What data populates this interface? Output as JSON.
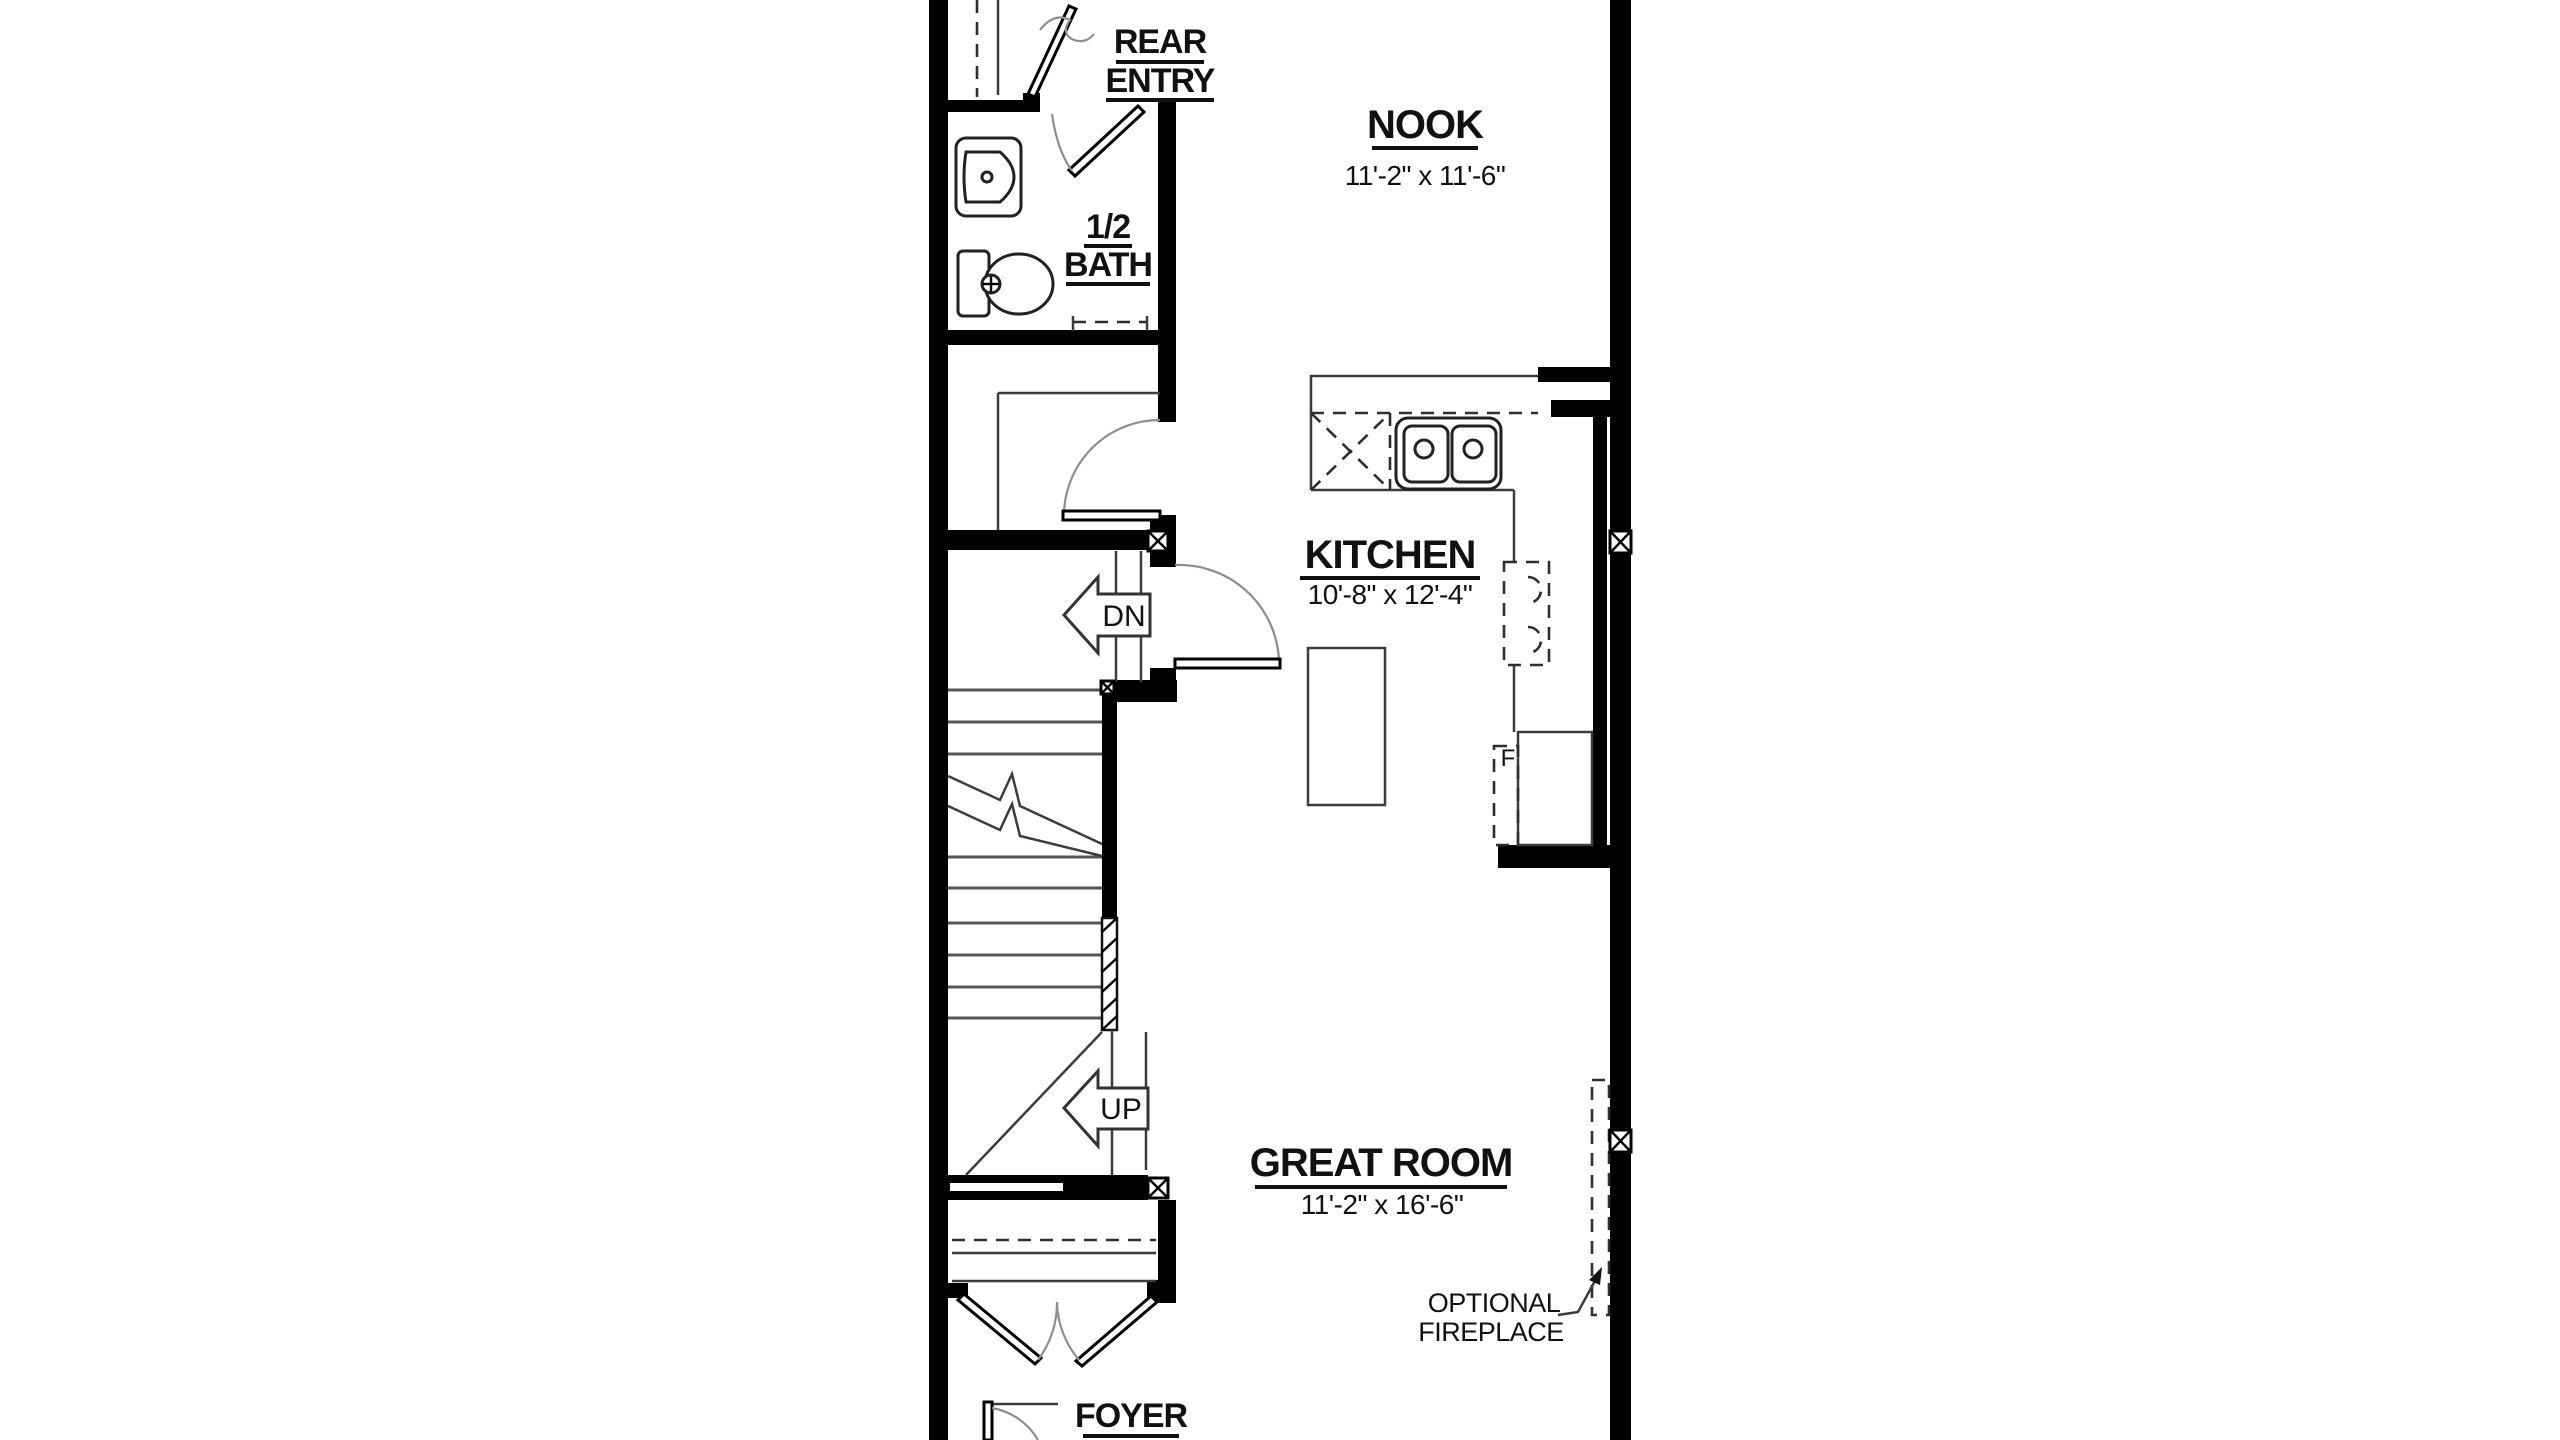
{
  "plan": {
    "rooms": {
      "rear_entry": {
        "line1": "REAR",
        "line2": "ENTRY"
      },
      "nook": {
        "name": "NOOK",
        "dims": "11'-2\" x 11'-6\""
      },
      "half_bath": {
        "line1": "1/2",
        "line2": "BATH"
      },
      "kitchen": {
        "name": "KITCHEN",
        "dims": "10'-8\" x 12'-4\""
      },
      "great_room": {
        "name": "GREAT ROOM",
        "dims": "11'-2\" x 16'-6\""
      },
      "foyer": {
        "name": "FOYER"
      }
    },
    "stairs": {
      "down_label": "DN",
      "up_label": "UP"
    },
    "annotations": {
      "fireplace_line1": "OPTIONAL",
      "fireplace_line2": "FIREPLACE",
      "fridge_label": "F"
    },
    "colors": {
      "wall": "#000000",
      "background": "#ffffff",
      "thin_line": "#3c3c3c"
    }
  }
}
